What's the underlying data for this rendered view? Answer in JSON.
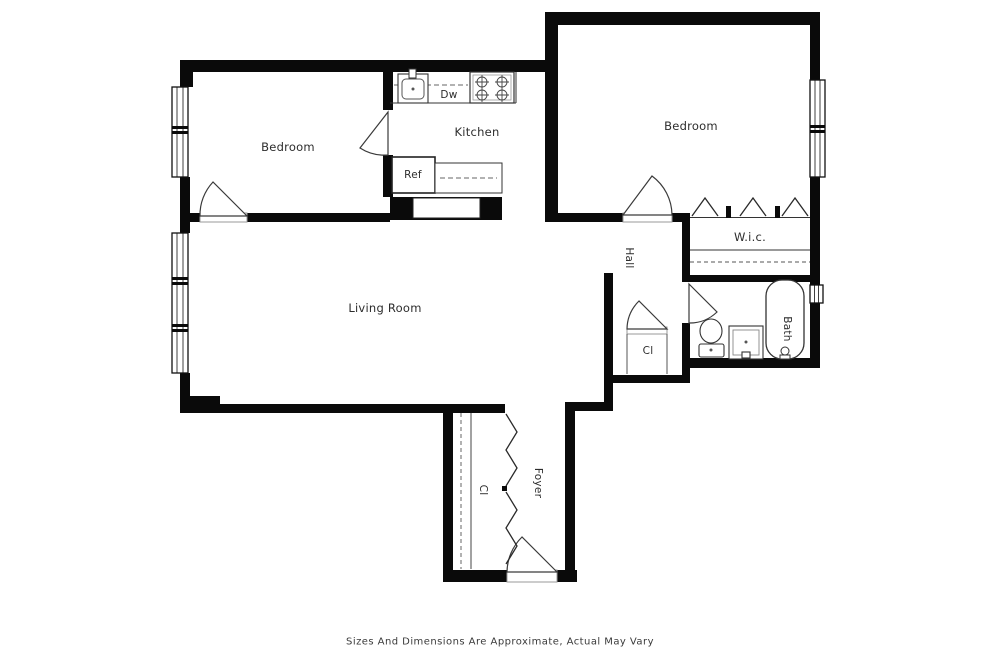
{
  "floor_plan": {
    "rooms": {
      "bedroom_left": "Bedroom",
      "kitchen": "Kitchen",
      "bedroom_right": "Bedroom",
      "walk_in_closet": "W.i.c.",
      "living_room": "Living Room",
      "hall": "Hall",
      "hall_closet": "Cl",
      "bath": "Bath",
      "foyer": "Foyer",
      "foyer_closet": "Cl"
    },
    "appliances": {
      "dishwasher": "Dw",
      "refrigerator": "Ref"
    },
    "fixtures": [
      "kitchen-sink",
      "stove",
      "bathtub",
      "toilet",
      "bathroom-sink"
    ],
    "footer": "Sizes And Dimensions Are Approximate, Actual May Vary"
  },
  "colors": {
    "background": "#ffffff",
    "walls": "#0a0a0a",
    "fixture_lines": "#333333",
    "label_text": "#2d2d2d",
    "threshold": "#999999"
  }
}
